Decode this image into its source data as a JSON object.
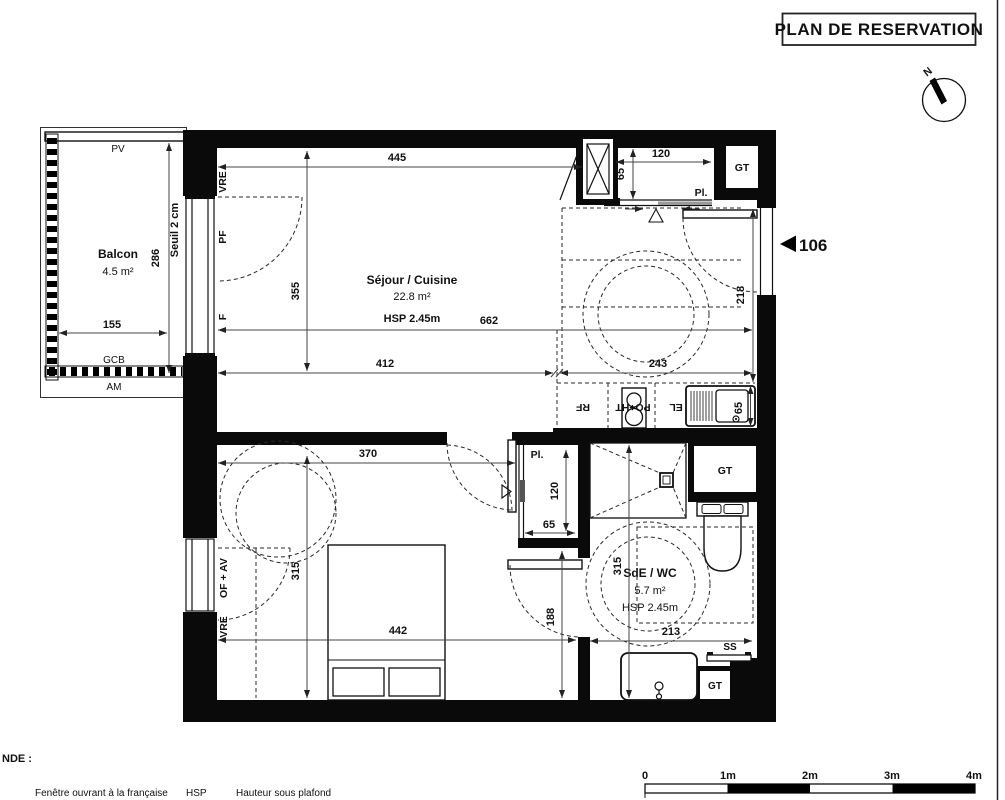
{
  "title": "PLAN DE RESERVATION",
  "unit": {
    "number": "106"
  },
  "compass": {
    "north": "N"
  },
  "rooms": {
    "balcon": {
      "name": "Balcon",
      "area": "4.5 m²"
    },
    "sejour": {
      "name": "Séjour / Cuisine",
      "area": "22.8 m²",
      "hsp": "HSP 2.45m"
    },
    "chambre": {
      "name": "Chambre",
      "area": "13.9 m²"
    },
    "sde": {
      "name": "SdE / WC",
      "area": "5.7 m²",
      "hsp": "HSP 2.45m"
    }
  },
  "dims": {
    "sejour_top": "445",
    "entry_closet_w": "120",
    "entry_closet_d": "65",
    "balcon_h": "286",
    "balcon_w": "155",
    "seuil": "Seuil 2 cm",
    "sejour_h": "355",
    "sejour_total_w": "662",
    "sejour_left_w": "412",
    "entry_w": "243",
    "entry_h": "218",
    "chambre_top": "370",
    "closet_h": "120",
    "closet_w": "65",
    "chambre_h": "315",
    "chambre_w": "442",
    "hall_h": "188",
    "sde_h": "315",
    "sde_w": "213",
    "kitchen_d": "65"
  },
  "codes": {
    "pv": "PV",
    "gcb": "GCB",
    "am": "AM",
    "vre_sejour": "VRE",
    "pf": "PF",
    "f": "F",
    "of_av": "OF + AV",
    "vre_chambre": "VRE",
    "pl_entry": "Pl.",
    "pl_chambre": "Pl.",
    "gt_entry": "GT",
    "gt_sde": "GT",
    "gt_bottom": "GT",
    "rf": "RF",
    "po_ht": "PO+HT",
    "el": "EL",
    "ss": "SS"
  },
  "legend": {
    "heading": "NDE :",
    "item1": "Fenêtre ouvrant à la française",
    "item2_abbr": "HSP",
    "item2_def": "Hauteur sous plafond"
  },
  "scale": {
    "t0": "0",
    "t1": "1m",
    "t2": "2m",
    "t3": "3m",
    "t4": "4m"
  }
}
